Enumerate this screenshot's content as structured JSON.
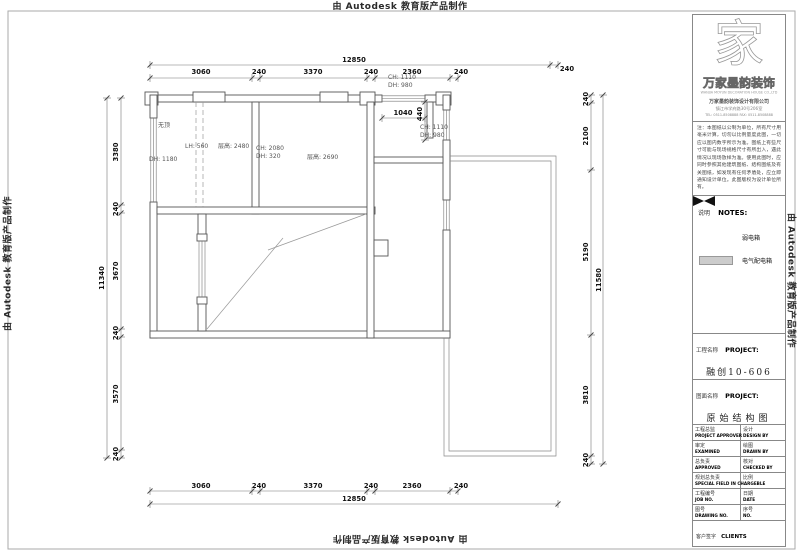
{
  "watermark": {
    "text": "由 Autodesk 教育版产品制作"
  },
  "title_block": {
    "logo_glyph": "家",
    "logo_name": "万家墨韵装饰",
    "logo_sub": "WANJIA MOYUN DECORATION HOUSE CO.,LTD",
    "company": "万家墨韵装饰设计有限公司",
    "address": "镇江市学府路30号206室",
    "phone": "TEL: 0511-8508888   FAX: 0511-8508888",
    "notes_text": "注：本图纸以公制为单位，所有尺寸用毫米计算，切勿以比例量度此图，一切应以图内数字所示为准。图纸上有些尺寸可能与现场规格尺寸有所出入，遇此情况以现场放样为准。使用此图时，应同时参照其他建筑图纸、结构图纸及有关图纸，如发现有任何矛盾处，应立即通知设计单位。此图版权为设计单位所有。",
    "notes_header_cn": "说明",
    "notes_header_en": "NOTES:",
    "legend": [
      {
        "symbol": "bowtie",
        "label": "弱电箱"
      },
      {
        "symbol": "box",
        "label": "电气配电箱"
      }
    ],
    "project_label_cn": "工程名称",
    "project_label_en": "PROJECT:",
    "project_value": "融创10-606",
    "drawing_label_cn": "图面名称",
    "drawing_label_en": "PROJECT:",
    "drawing_value": "原始结构图",
    "table_rows": [
      {
        "l_cn": "工程总监",
        "l_en": "PROJECT APPROVER",
        "r_cn": "设计",
        "r_en": "DESIGN BY"
      },
      {
        "l_cn": "审定",
        "l_en": "EXAMINED",
        "r_cn": "绘图",
        "r_en": "DRAWN BY"
      },
      {
        "l_cn": "总负责",
        "l_en": "APPROVED",
        "r_cn": "核对",
        "r_en": "CHECKED BY"
      },
      {
        "l_cn": "规划总负责",
        "l_en": "SPECIAL FIELD IN CHARGEBLE",
        "r_cn": "比例",
        "r_en": ""
      },
      {
        "l_cn": "工程编号",
        "l_en": "JOB NO.",
        "r_cn": "日期",
        "r_en": "DATE"
      },
      {
        "l_cn": "图号",
        "l_en": "DRAWING NO.",
        "r_cn": "序号",
        "r_en": "NO."
      }
    ],
    "clients_cn": "客户签字",
    "clients_en": "CLIENTS"
  },
  "plan": {
    "dim_chains": [
      {
        "dir": "h",
        "y": 65,
        "x1": 150,
        "x2": 558,
        "ticks": [
          150,
          550,
          558
        ],
        "labels": [
          {
            "t": "12850",
            "x": 354,
            "y": 62
          },
          {
            "t": "240",
            "x": 567,
            "y": 71
          }
        ]
      },
      {
        "dir": "h",
        "y": 78,
        "x1": 150,
        "x2": 458,
        "ticks": [
          150,
          252,
          260,
          367,
          375,
          450,
          458
        ],
        "labels": [
          {
            "t": "3060",
            "x": 201,
            "y": 74
          },
          {
            "t": "240",
            "x": 259,
            "y": 74
          },
          {
            "t": "3370",
            "x": 313,
            "y": 74
          },
          {
            "t": "240",
            "x": 371,
            "y": 74
          },
          {
            "t": "2360",
            "x": 412,
            "y": 74
          },
          {
            "t": "240",
            "x": 461,
            "y": 74
          }
        ]
      },
      {
        "dir": "h",
        "y": 491,
        "x1": 150,
        "x2": 458,
        "ticks": [
          150,
          252,
          260,
          367,
          375,
          450,
          458
        ],
        "labels": [
          {
            "t": "3060",
            "x": 201,
            "y": 488
          },
          {
            "t": "240",
            "x": 259,
            "y": 488
          },
          {
            "t": "3370",
            "x": 313,
            "y": 488
          },
          {
            "t": "240",
            "x": 371,
            "y": 488
          },
          {
            "t": "2360",
            "x": 412,
            "y": 488
          },
          {
            "t": "240",
            "x": 461,
            "y": 488
          }
        ]
      },
      {
        "dir": "h",
        "y": 504,
        "x1": 150,
        "x2": 558,
        "ticks": [
          150,
          558
        ],
        "labels": [
          {
            "t": "12850",
            "x": 354,
            "y": 501
          }
        ]
      },
      {
        "dir": "v",
        "x": 107,
        "y1": 98,
        "y2": 458,
        "ticks": [
          98,
          458
        ],
        "labels": [
          {
            "t": "11340",
            "x": 104,
            "y": 278,
            "rot": -90
          }
        ]
      },
      {
        "dir": "v",
        "x": 121,
        "y1": 98,
        "y2": 458,
        "ticks": [
          98,
          205,
          213,
          329,
          337,
          450,
          458
        ],
        "labels": [
          {
            "t": "3380",
            "x": 118,
            "y": 152,
            "rot": -90
          },
          {
            "t": "240",
            "x": 118,
            "y": 209,
            "rot": -90
          },
          {
            "t": "3670",
            "x": 118,
            "y": 271,
            "rot": -90
          },
          {
            "t": "240",
            "x": 118,
            "y": 333,
            "rot": -90
          },
          {
            "t": "3570",
            "x": 118,
            "y": 394,
            "rot": -90
          },
          {
            "t": "240",
            "x": 118,
            "y": 454,
            "rot": -90
          }
        ]
      },
      {
        "dir": "v",
        "x": 591,
        "y1": 95,
        "y2": 464,
        "ticks": [
          95,
          103,
          170,
          335,
          456,
          464
        ],
        "labels": [
          {
            "t": "240",
            "x": 588,
            "y": 99,
            "rot": -90
          },
          {
            "t": "2100",
            "x": 588,
            "y": 136,
            "rot": -90
          },
          {
            "t": "5190",
            "x": 588,
            "y": 252,
            "rot": -90
          },
          {
            "t": "3810",
            "x": 588,
            "y": 395,
            "rot": -90
          },
          {
            "t": "240",
            "x": 588,
            "y": 460,
            "rot": -90
          }
        ]
      },
      {
        "dir": "v",
        "x": 603,
        "y1": 95,
        "y2": 464,
        "ticks": [
          95,
          464
        ],
        "labels": [
          {
            "t": "11580",
            "x": 601,
            "y": 280,
            "rot": -90
          }
        ]
      },
      {
        "dir": "h",
        "y": 118,
        "x1": 382,
        "x2": 425,
        "ticks": [
          382,
          425
        ],
        "labels": [
          {
            "t": "1040",
            "x": 403,
            "y": 115
          }
        ]
      },
      {
        "dir": "v",
        "x": 425,
        "y1": 102,
        "y2": 140,
        "ticks": [
          102,
          140
        ],
        "labels": [
          {
            "t": "440",
            "x": 422,
            "y": 114,
            "rot": -90
          }
        ]
      }
    ],
    "room_labels": [
      {
        "t": "无顶",
        "x": 158,
        "y": 127
      },
      {
        "t": "LH: 560",
        "x": 185,
        "y": 148
      },
      {
        "t": "层高: 2480",
        "x": 218,
        "y": 148
      },
      {
        "t": "DH: 1180",
        "x": 149,
        "y": 161
      },
      {
        "t": "CH: 2080",
        "x": 256,
        "y": 150
      },
      {
        "t": "DH: 320",
        "x": 256,
        "y": 158
      },
      {
        "t": "层高: 2690",
        "x": 307,
        "y": 159
      },
      {
        "t": "CH: 1110",
        "x": 388,
        "y": 79
      },
      {
        "t": "DH: 980",
        "x": 388,
        "y": 87
      },
      {
        "t": "CH: 1110",
        "x": 420,
        "y": 129
      },
      {
        "t": "DH: 980",
        "x": 420,
        "y": 137
      }
    ]
  }
}
